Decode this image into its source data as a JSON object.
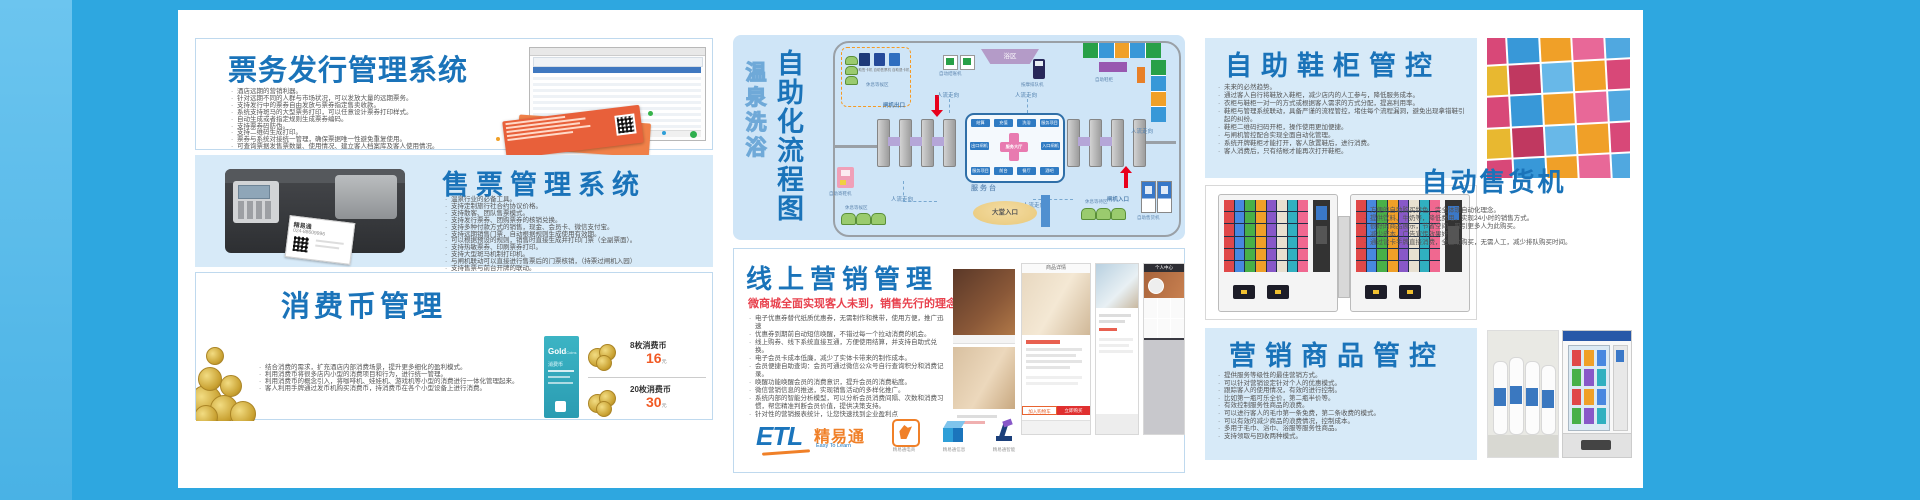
{
  "colors": {
    "accent_blue": "#1a73b9",
    "panel_blue": "#d7eaf8",
    "board_blue": "#2ea7e0",
    "subtitle_red": "#e8414d",
    "price_orange": "#f15a24",
    "ticket_orange": "#e8603a",
    "logo_orange": "#f08028"
  },
  "p1": {
    "title": "票务发行管理系统",
    "bullets": [
      "酒店远期的营销利器。",
      "针对远期不同的人群与市场状况，可以发放大量的远期票务。",
      "支持发行中的票券自由发放与票券指定售卖收款。",
      "系统支持斑马的大型票务打印，可以任意设计票券打印样式。",
      "自动生成或者指定规则生成票券编码。",
      "支持票券码防伪。",
      "支持二维码生成打印。",
      "票券与系统对接统一管理，确保票据唯一性避免重复使用。",
      "可查询票据发售票数量、使用情况、建立客人档案库及客人使用情况。"
    ]
  },
  "p2": {
    "title": "售票管理系统",
    "printer_brand": "精易通",
    "printer_phone": "024-88609996",
    "bullets": [
      "温泉行业的必备工具。",
      "支持定制旅行社合约协议价格。",
      "支持散客、团队售票模式。",
      "支持发行票券、团购票券的核销兑换。",
      "支持多种付款方式的销售，现金、会员卡、微信支付宝。",
      "支持远期销售门票，自动根据规则生成使用有效期。",
      "可以根据预设的规则，销售时直接生成并打印门票（全副票面）。",
      "支持热敏票券、印刷票券打印。",
      "支持大型斑马机制打印机。",
      "与闸机联动可以直接进行售票后的门票核销，（持票过闸机入园）",
      "支持售票与前台开牌的联动。"
    ]
  },
  "p3": {
    "title": "消费币管理",
    "bullets": [
      "结合消费的需求，扩充酒店内部消费场景，提升更多细化的盈利模式。",
      "利用消费币将很多店内小型的消费项目和行为，进行统一管理。",
      "利用消费币的概念引入，将咖啡机、娃娃机、游戏机等小型的消费进行一体化管理起来。",
      "客人利用手牌通过发币机购买消费币，持消费币在各个小型设备上进行消费。"
    ],
    "card": {
      "word1": "Gold",
      "word2": "Coins",
      "label": "消费币"
    },
    "prices": [
      {
        "name": "8枚消费币",
        "price": "16",
        "unit": "元"
      },
      {
        "name": "20枚消费币",
        "price": "30",
        "unit": "元"
      }
    ]
  },
  "flow": {
    "title": "自助化流程图",
    "subtitle": "温泉洗浴",
    "labels": {
      "kiosk1": "自助售卡机",
      "kiosk2": "自助售票机",
      "kiosk3": "自助退卡机",
      "wait1": "休息等候区",
      "checkout": "自动结账机",
      "bath": "浴区",
      "queue": "按摩排队机",
      "lockers": "自助鞋柜",
      "gate_out": "闸机出口",
      "gate_in": "闸机入口",
      "desk": "服务台",
      "lobby": "大堂入口",
      "deposit": "自助寄鞋机",
      "wait2": "休息等候区",
      "wait3": "休息等待区",
      "vending": "自助售货机",
      "flow_dir": "人流走向",
      "hall": "服务大厅",
      "chips_top": [
        "结算",
        "充值",
        "洗浴",
        "服务项目"
      ],
      "chip_left": "出口闸机",
      "chip_right": "入口闸机",
      "chips_bottom": [
        "服务项目",
        "前台",
        "餐厅",
        "酒吧"
      ]
    }
  },
  "mkt": {
    "title": "线上营销管理",
    "subtitle": "微商城全面实现客人未到，销售先行的理念",
    "bullets": [
      "电子优惠券替代纸质优惠券，无需制作和携带，使用方便，推广迅速",
      "优惠券到期前自动短信唤醒，不错过每一个拉动消费的机会。",
      "线上购券、线下系统直接互通，方便使用结算，并支持自助式兑换。",
      "电子会员卡成本低廉，减少了实体卡带来的制作成本。",
      "会员便捷自助查询：会员可通过微信公众号自行查询积分和消费记录。",
      "唤醒功能唤醒会员的消费意识，提升会员的消费粘度。",
      "微信营销信息的推送，实现销售活动的多样化推广。",
      "系统内部的智能分析模型，可以分析会员消费间隔、次数和消费习惯，帮您精准判断会员价值，提供决策支持。",
      "针对性的营销报表统计，让您快速找到企业盈利点"
    ],
    "screens": {
      "detail_header": "商品详情",
      "btn_cart": "加入购物车",
      "btn_buy": "立即购买",
      "profile_header": "个人中心"
    },
    "logo": {
      "abbr": "ETL",
      "cn": "精易通",
      "tagline": "Easy To Learn"
    },
    "companies": [
      "精易通电商",
      "精易通信息",
      "精易通智能"
    ]
  },
  "shoe": {
    "title": "自助鞋柜管控",
    "bullets": [
      "未来的必然趋势。",
      "通过客人自行将鞋放入鞋柜，减少店内的人工参与，降低服务成本。",
      "衣柜与鞋柜一对一的方式或根据客人需求的方式分配，提高利用率。",
      "鞋柜与管理系统联动，具备严谨的流程管控，堵住每个流程漏洞，避免出现拿错鞋引起的纠纷。",
      "鞋柜二维码扫码开柜，操作使用更加便捷。",
      "与闸机管控配合实现全面自动化管理。",
      "系统开牌鞋柜才能打开，客人放置鞋后，进行消费。",
      "客人消费后，只有结帐才能再次打开鞋柜。"
    ]
  },
  "vend": {
    "title": "自动售货机",
    "bullets": [
      "方便的自助购买特色，完全体现自动化理念。",
      "提供饮料、牛奶等，降低费用，实现24小时的销售方式。",
      "很好的商品展示，节省空间，吸引更多人为此购买。",
      "减少成本，广告宣传效果好。",
      "通过读卡手牌直接消费，全自助购买，无需人工，减少排队购买时间。"
    ]
  },
  "goods": {
    "title": "营销商品管控",
    "bullets": [
      "提供服务等级性的最佳营销方式。",
      "可以针对营销设定针对个人的优惠模式。",
      "跟踪客人的使用情况，有效的进行控制。",
      "比如第一瓶可乐全价，第二瓶半价等。",
      "有效控制服务性商品的浪费。",
      "可以进行客人的毛巾第一条免费，第二条收费的模式。",
      "可以有效的减少商品的浪费情况，控制成本。",
      "多用于毛巾、浴巾、浴服等服务性商品。",
      "支持领取与回收两种模式。"
    ]
  },
  "photos": {
    "locker_palette": [
      "#d84878",
      "#3898d8",
      "#f0a028",
      "#e86898",
      "#50a8e0",
      "#e8b830",
      "#c03860",
      "#68b8e8",
      "#f0a028",
      "#d84878"
    ],
    "bottle_palette": [
      "#e04848",
      "#4888e0",
      "#48b048",
      "#f0a028",
      "#8858c8",
      "#e8e0d0",
      "#30b0c0",
      "#f06890"
    ],
    "flow_locker_palette": [
      "#28a048",
      "#3898d8",
      "#f0a028",
      "#3898d8",
      "#28a048",
      "#f0a028",
      "#3898d8",
      "#28a048"
    ],
    "shelf_palette": [
      "#e04848",
      "#f0a028",
      "#4888e0",
      "#48b048",
      "#8858c8",
      "#30b0c0"
    ]
  }
}
